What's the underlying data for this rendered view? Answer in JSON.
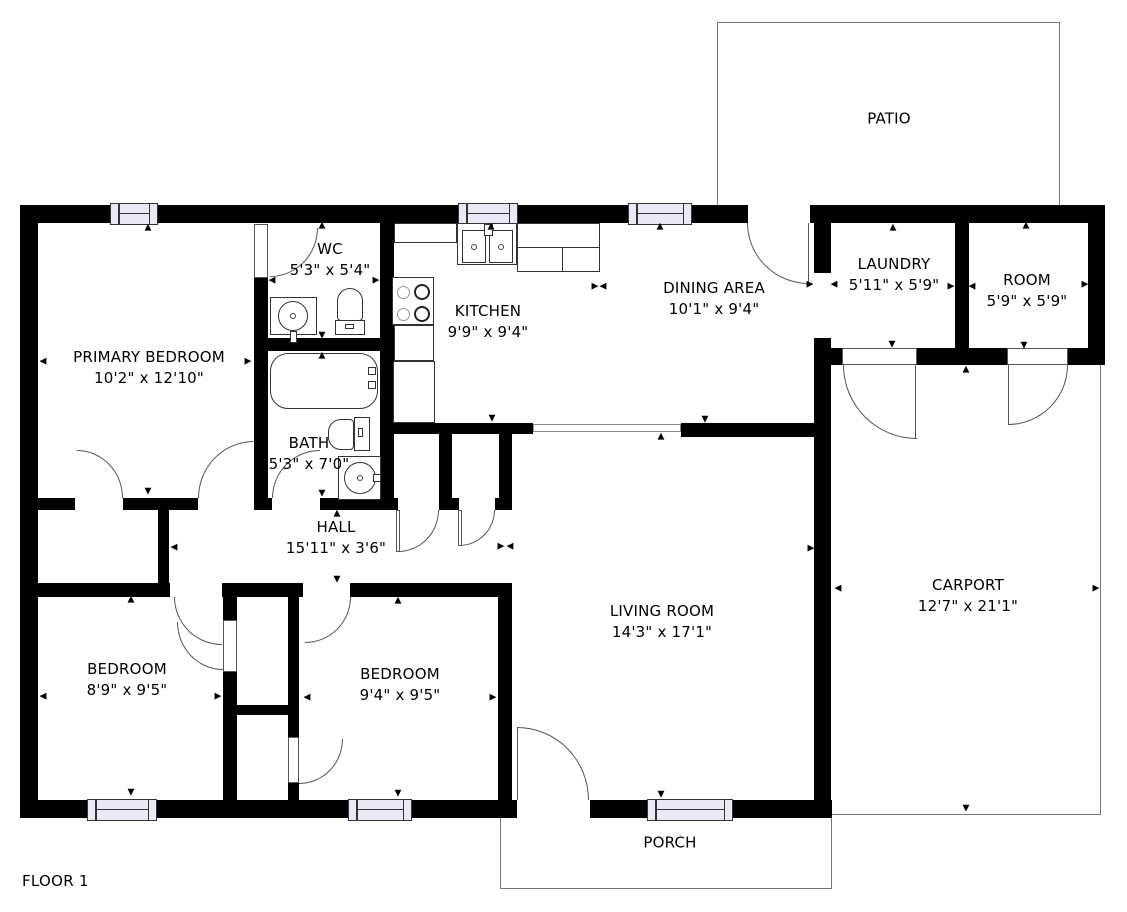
{
  "title": "FLOOR 1",
  "rooms": {
    "patio": {
      "name": "PATIO"
    },
    "primary_bedroom": {
      "name": "PRIMARY BEDROOM",
      "dims": "10'2\" x 12'10\""
    },
    "wc": {
      "name": "WC",
      "dims": "5'3\" x 5'4\""
    },
    "kitchen": {
      "name": "KITCHEN",
      "dims": "9'9\" x 9'4\""
    },
    "dining": {
      "name": "DINING AREA",
      "dims": "10'1\" x 9'4\""
    },
    "laundry": {
      "name": "LAUNDRY",
      "dims": "5'11\" x 5'9\""
    },
    "room": {
      "name": "ROOM",
      "dims": "5'9\" x 5'9\""
    },
    "bath": {
      "name": "BATH",
      "dims": "5'3\" x 7'0\""
    },
    "hall": {
      "name": "HALL",
      "dims": "15'11\" x 3'6\""
    },
    "living": {
      "name": "LIVING ROOM",
      "dims": "14'3\" x 17'1\""
    },
    "carport": {
      "name": "CARPORT",
      "dims": "12'7\" x 21'1\""
    },
    "bedroom_left": {
      "name": "BEDROOM",
      "dims": "8'9\" x 9'5\""
    },
    "bedroom_mid": {
      "name": "BEDROOM",
      "dims": "9'4\" x 9'5\""
    },
    "porch": {
      "name": "PORCH"
    }
  },
  "icons": {
    "marker_up": "▲",
    "marker_down": "▼",
    "marker_left": "◀",
    "marker_right": "▶"
  },
  "colors": {
    "wall": "#000000",
    "window_fill": "#e8e8f6",
    "outline": "#6f6f6f",
    "background": "#ffffff"
  }
}
